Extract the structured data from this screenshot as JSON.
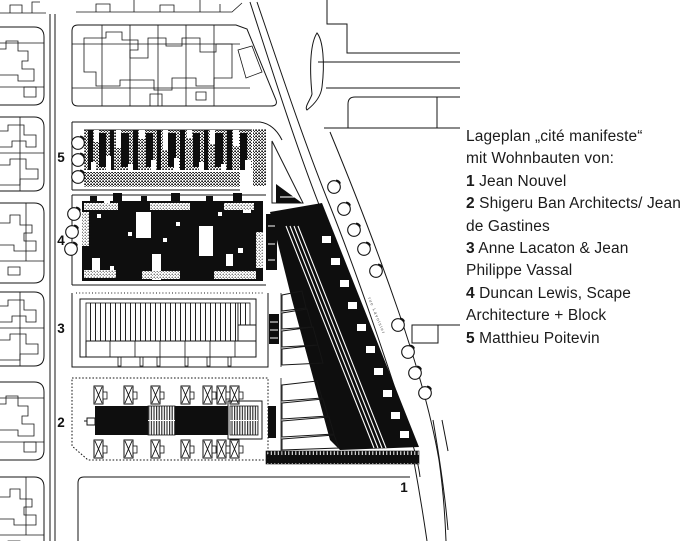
{
  "colors": {
    "ink": "#161616",
    "paper": "#ffffff"
  },
  "caption": {
    "lines": [
      {
        "bold": "",
        "text": "Lageplan „cité manifeste“"
      },
      {
        "bold": "",
        "text": "mit Wohnbauten von:"
      },
      {
        "bold": "1",
        "text": " Jean Nouvel"
      },
      {
        "bold": "2",
        "text": " Shigeru Ban Architects/ Jean"
      },
      {
        "bold": "",
        "text": "de Gastines"
      },
      {
        "bold": "3",
        "text": " Anne Lacaton & Jean"
      },
      {
        "bold": "",
        "text": "Philippe Vassal"
      },
      {
        "bold": "4",
        "text": " Duncan Lewis, Scape"
      },
      {
        "bold": "",
        "text": "Architecture + Block"
      },
      {
        "bold": "5",
        "text": " Matthieu Poitevin"
      }
    ]
  },
  "plan": {
    "street_label": "rue Lavoisier",
    "block_labels": [
      {
        "id": "5",
        "x": 61,
        "y": 162
      },
      {
        "id": "4",
        "x": 61,
        "y": 245
      },
      {
        "id": "3",
        "x": 61,
        "y": 333
      },
      {
        "id": "2",
        "x": 61,
        "y": 427
      },
      {
        "id": "1",
        "x": 404,
        "y": 492
      }
    ]
  }
}
